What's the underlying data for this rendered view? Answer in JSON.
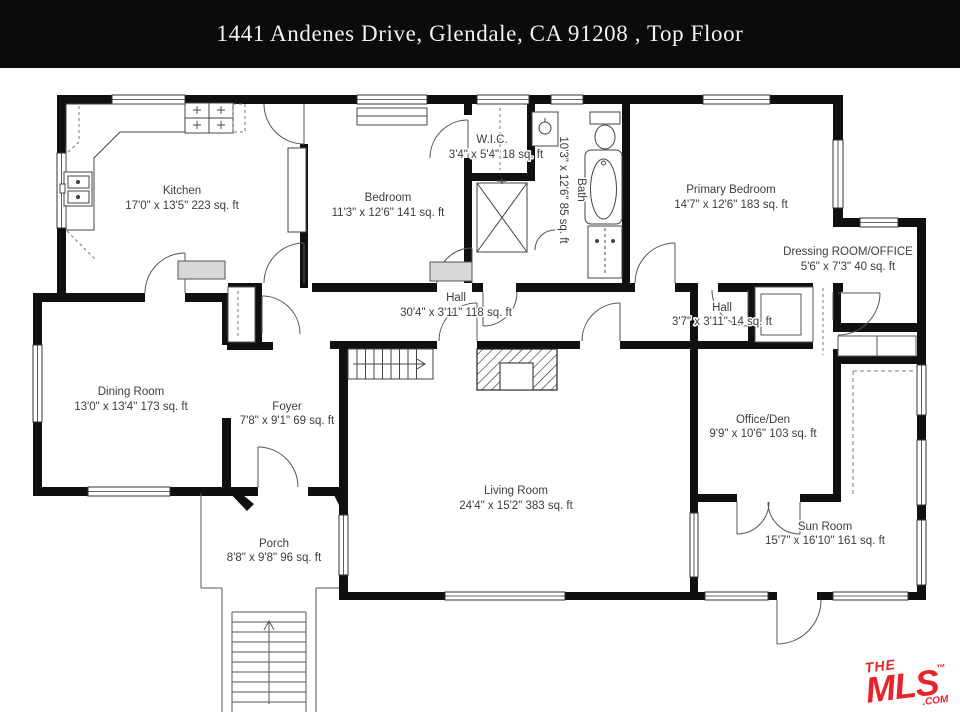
{
  "header": {
    "title": "1441 Andenes Drive, Glendale, CA  91208 , Top Floor"
  },
  "floor_plan": {
    "rooms": [
      {
        "id": "kitchen",
        "name": "Kitchen",
        "dims": "17'0\" x 13'5\" 223 sq. ft"
      },
      {
        "id": "bedroom",
        "name": "Bedroom",
        "dims": "11'3\" x 12'6\" 141 sq. ft"
      },
      {
        "id": "wic",
        "name": "W.I.C.",
        "dims": "3'4\" x 5'4\" 18 sq. ft"
      },
      {
        "id": "bath",
        "name": "Bath",
        "dims": "10'3\" x 12'6\" 85 sq. ft"
      },
      {
        "id": "primary_bedroom",
        "name": "Primary Bedroom",
        "dims": "14'7\" x 12'6\" 183 sq. ft"
      },
      {
        "id": "dressing",
        "name": "Dressing ROOM/OFFICE",
        "dims": "5'6\" x 7'3\" 40 sq. ft"
      },
      {
        "id": "hall",
        "name": "Hall",
        "dims": "30'4\" x 3'11\" 118 sq. ft"
      },
      {
        "id": "hall_small",
        "name": "Hall",
        "dims": "3'7\" x 3'11\" 14 sq. ft"
      },
      {
        "id": "dining",
        "name": "Dining Room",
        "dims": "13'0\" x 13'4\" 173 sq. ft"
      },
      {
        "id": "foyer",
        "name": "Foyer",
        "dims": "7'8\" x 9'1\" 69 sq. ft"
      },
      {
        "id": "office_den",
        "name": "Office/Den",
        "dims": "9'9\" x 10'6\" 103 sq. ft"
      },
      {
        "id": "living",
        "name": "Living Room",
        "dims": "24'4\" x 15'2\" 383 sq. ft"
      },
      {
        "id": "sun_room",
        "name": "Sun Room",
        "dims": "15'7\" x 16'10\" 161 sq. ft"
      },
      {
        "id": "porch",
        "name": "Porch",
        "dims": "8'8\" x 9'8\" 96 sq. ft"
      }
    ]
  },
  "branding": {
    "the": "THE",
    "mls": "MLS",
    "tm": "™",
    "com": ".COM",
    "color": "#e8232b"
  },
  "colors": {
    "header_bg": "#0b0b0b",
    "wall": "#101010",
    "label_text": "#3d3d3d"
  }
}
